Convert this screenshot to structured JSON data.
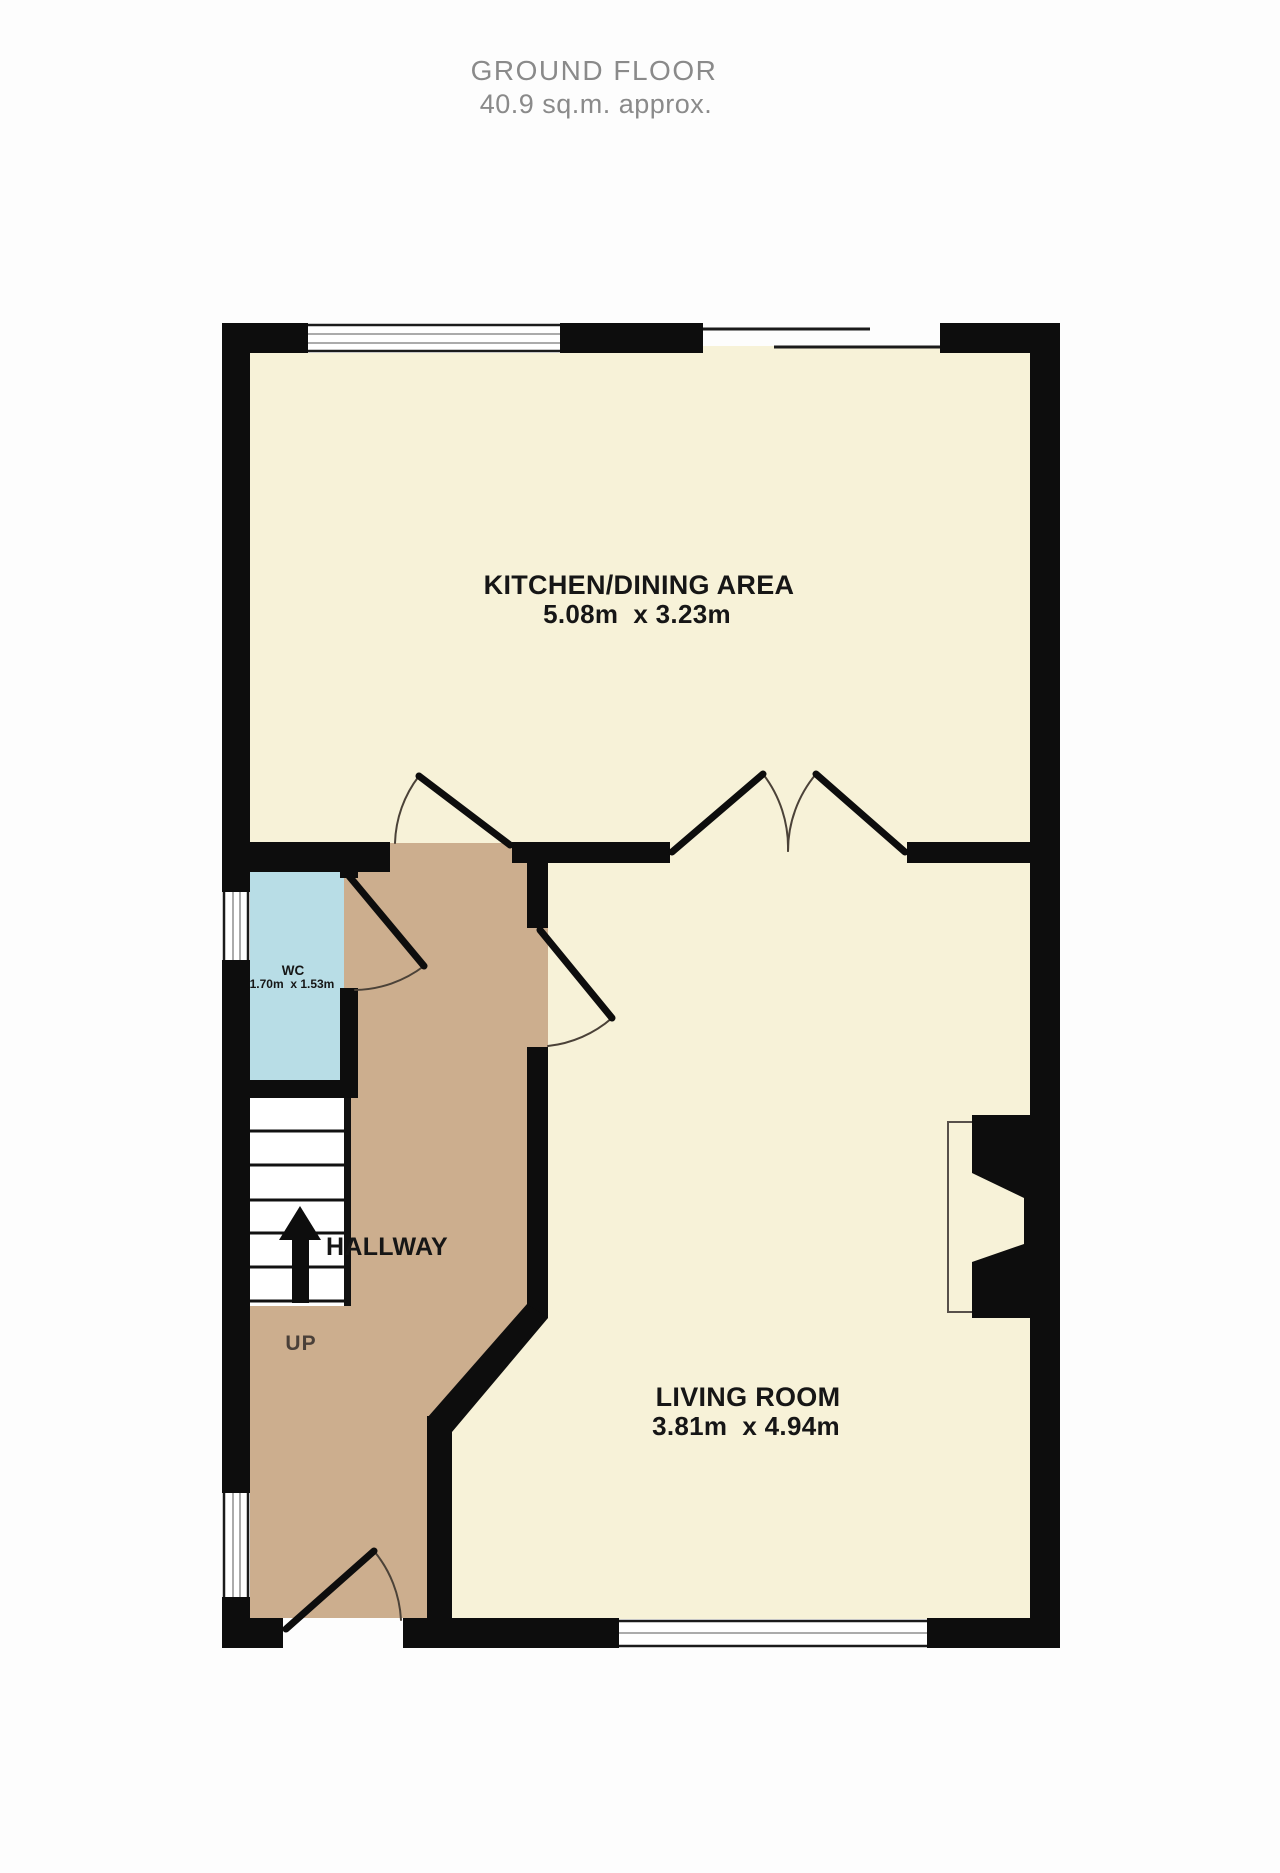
{
  "header": {
    "title": "GROUND FLOOR",
    "subtitle": "40.9 sq.m. approx."
  },
  "rooms": {
    "kitchen": {
      "name": "KITCHEN/DINING AREA",
      "dimensions": "5.08m  x 3.23m"
    },
    "living": {
      "name": "LIVING ROOM",
      "dimensions": "3.81m  x 4.94m"
    },
    "wc": {
      "name": "WC",
      "dimensions": "1.70m  x 1.53m"
    },
    "hallway": {
      "name": "HALLWAY"
    }
  },
  "stairs": {
    "direction_label": "UP"
  },
  "colors": {
    "wall": "#0d0d0d",
    "room_fill": "#f7f2d8",
    "hallway_fill": "#ccae8e",
    "wc_fill": "#b8dde6",
    "stairs_fill": "#ffffff",
    "thin_line": "#4b4238",
    "window_pane_line": "#8f8f8f",
    "title_text": "#8a8a8a",
    "label_text": "#161616"
  }
}
